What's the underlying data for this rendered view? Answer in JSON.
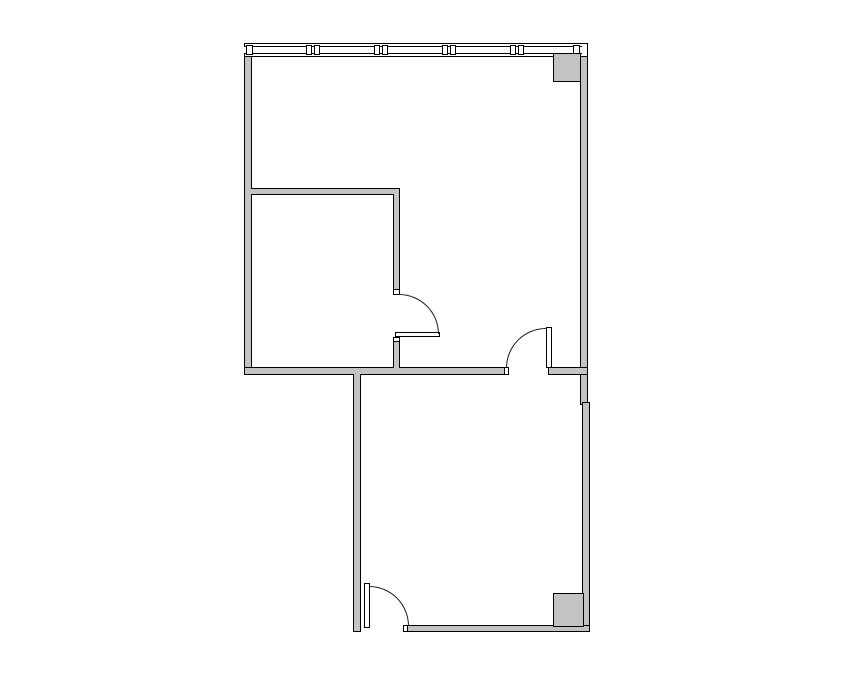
{
  "floorplan": {
    "canvas": {
      "width": 855,
      "height": 678
    },
    "colors": {
      "background": "#ffffff",
      "wall_fill": "#c3c3c3",
      "wall_outline": "#000000",
      "door_arc": "#1a1a1a"
    },
    "walls": [
      {
        "name": "left-wall",
        "x": 244,
        "y": 56,
        "w": 8,
        "h": 319
      },
      {
        "name": "top-right-wall",
        "x": 580,
        "y": 44,
        "w": 8,
        "h": 361
      },
      {
        "name": "middle-wall-west",
        "x": 244,
        "y": 367,
        "w": 261,
        "h": 8
      },
      {
        "name": "middle-wall-east",
        "x": 548,
        "y": 367,
        "w": 40,
        "h": 8
      },
      {
        "name": "inner-room-top-wall",
        "x": 251,
        "y": 188,
        "w": 149,
        "h": 7
      },
      {
        "name": "inner-room-right-wall",
        "x": 393,
        "y": 194,
        "w": 7,
        "h": 101
      },
      {
        "name": "inner-room-right-wall-stub",
        "x": 393,
        "y": 337,
        "w": 7,
        "h": 31
      },
      {
        "name": "lower-room-left-wall",
        "x": 353,
        "y": 374,
        "w": 8,
        "h": 258
      },
      {
        "name": "lower-room-right-wall",
        "x": 582,
        "y": 402,
        "w": 8,
        "h": 230
      },
      {
        "name": "lower-room-bottom-wall",
        "x": 407,
        "y": 625,
        "w": 183,
        "h": 7
      }
    ],
    "joints": [
      {
        "x": 246,
        "y": 189,
        "w": 7,
        "h": 5
      },
      {
        "x": 394,
        "y": 193,
        "w": 5,
        "h": 3
      },
      {
        "x": 246,
        "y": 368,
        "w": 7,
        "h": 6
      },
      {
        "x": 394,
        "y": 366,
        "w": 5,
        "h": 3
      },
      {
        "x": 581,
        "y": 368,
        "w": 6,
        "h": 6
      },
      {
        "x": 354,
        "y": 373,
        "w": 6,
        "h": 3
      },
      {
        "x": 582,
        "y": 626,
        "w": 7,
        "h": 5
      }
    ],
    "window_band": {
      "outer": {
        "x": 244,
        "y": 43,
        "w": 344,
        "h": 14
      },
      "inner": {
        "x": 244,
        "y": 46,
        "w": 338,
        "h": 8
      },
      "mullion_blocks": [
        {
          "x": 246,
          "y": 45,
          "w": 7,
          "h": 10
        },
        {
          "x": 306,
          "y": 45,
          "w": 6,
          "h": 10
        },
        {
          "x": 314,
          "y": 45,
          "w": 6,
          "h": 10
        },
        {
          "x": 374,
          "y": 45,
          "w": 6,
          "h": 10
        },
        {
          "x": 382,
          "y": 45,
          "w": 6,
          "h": 10
        },
        {
          "x": 442,
          "y": 45,
          "w": 6,
          "h": 10
        },
        {
          "x": 450,
          "y": 45,
          "w": 6,
          "h": 10
        },
        {
          "x": 510,
          "y": 45,
          "w": 6,
          "h": 10
        },
        {
          "x": 518,
          "y": 45,
          "w": 6,
          "h": 10
        },
        {
          "x": 573,
          "y": 45,
          "w": 7,
          "h": 10
        }
      ]
    },
    "columns": [
      {
        "name": "upper-right-column",
        "x": 553,
        "y": 53,
        "w": 28,
        "h": 29
      },
      {
        "name": "lower-right-column",
        "x": 553,
        "y": 593,
        "w": 31,
        "h": 34
      }
    ],
    "caps": [
      {
        "name": "inner-door-north-cap",
        "x": 393,
        "y": 289,
        "w": 7,
        "h": 6
      },
      {
        "name": "inner-door-south-cap",
        "x": 393,
        "y": 337,
        "w": 7,
        "h": 5
      },
      {
        "name": "upper-door-west-cap",
        "x": 504,
        "y": 367,
        "w": 5,
        "h": 8
      },
      {
        "name": "lower-door-east-cap",
        "x": 403,
        "y": 625,
        "w": 5,
        "h": 7
      }
    ],
    "doors": [
      {
        "name": "inner-room-door",
        "leaf": {
          "x": 395,
          "y": 332,
          "w": 45,
          "h": 5
        },
        "arc": {
          "x": 399,
          "y": 294,
          "size": 40,
          "corner": "tr"
        }
      },
      {
        "name": "upper-room-door",
        "leaf": {
          "x": 546,
          "y": 327,
          "w": 6,
          "h": 41
        },
        "arc": {
          "x": 506,
          "y": 328,
          "size": 40,
          "corner": "tl"
        }
      },
      {
        "name": "lower-room-door",
        "leaf": {
          "x": 364,
          "y": 583,
          "w": 6,
          "h": 45
        },
        "arc": {
          "x": 369,
          "y": 586,
          "size": 40,
          "corner": "tr"
        }
      }
    ]
  }
}
